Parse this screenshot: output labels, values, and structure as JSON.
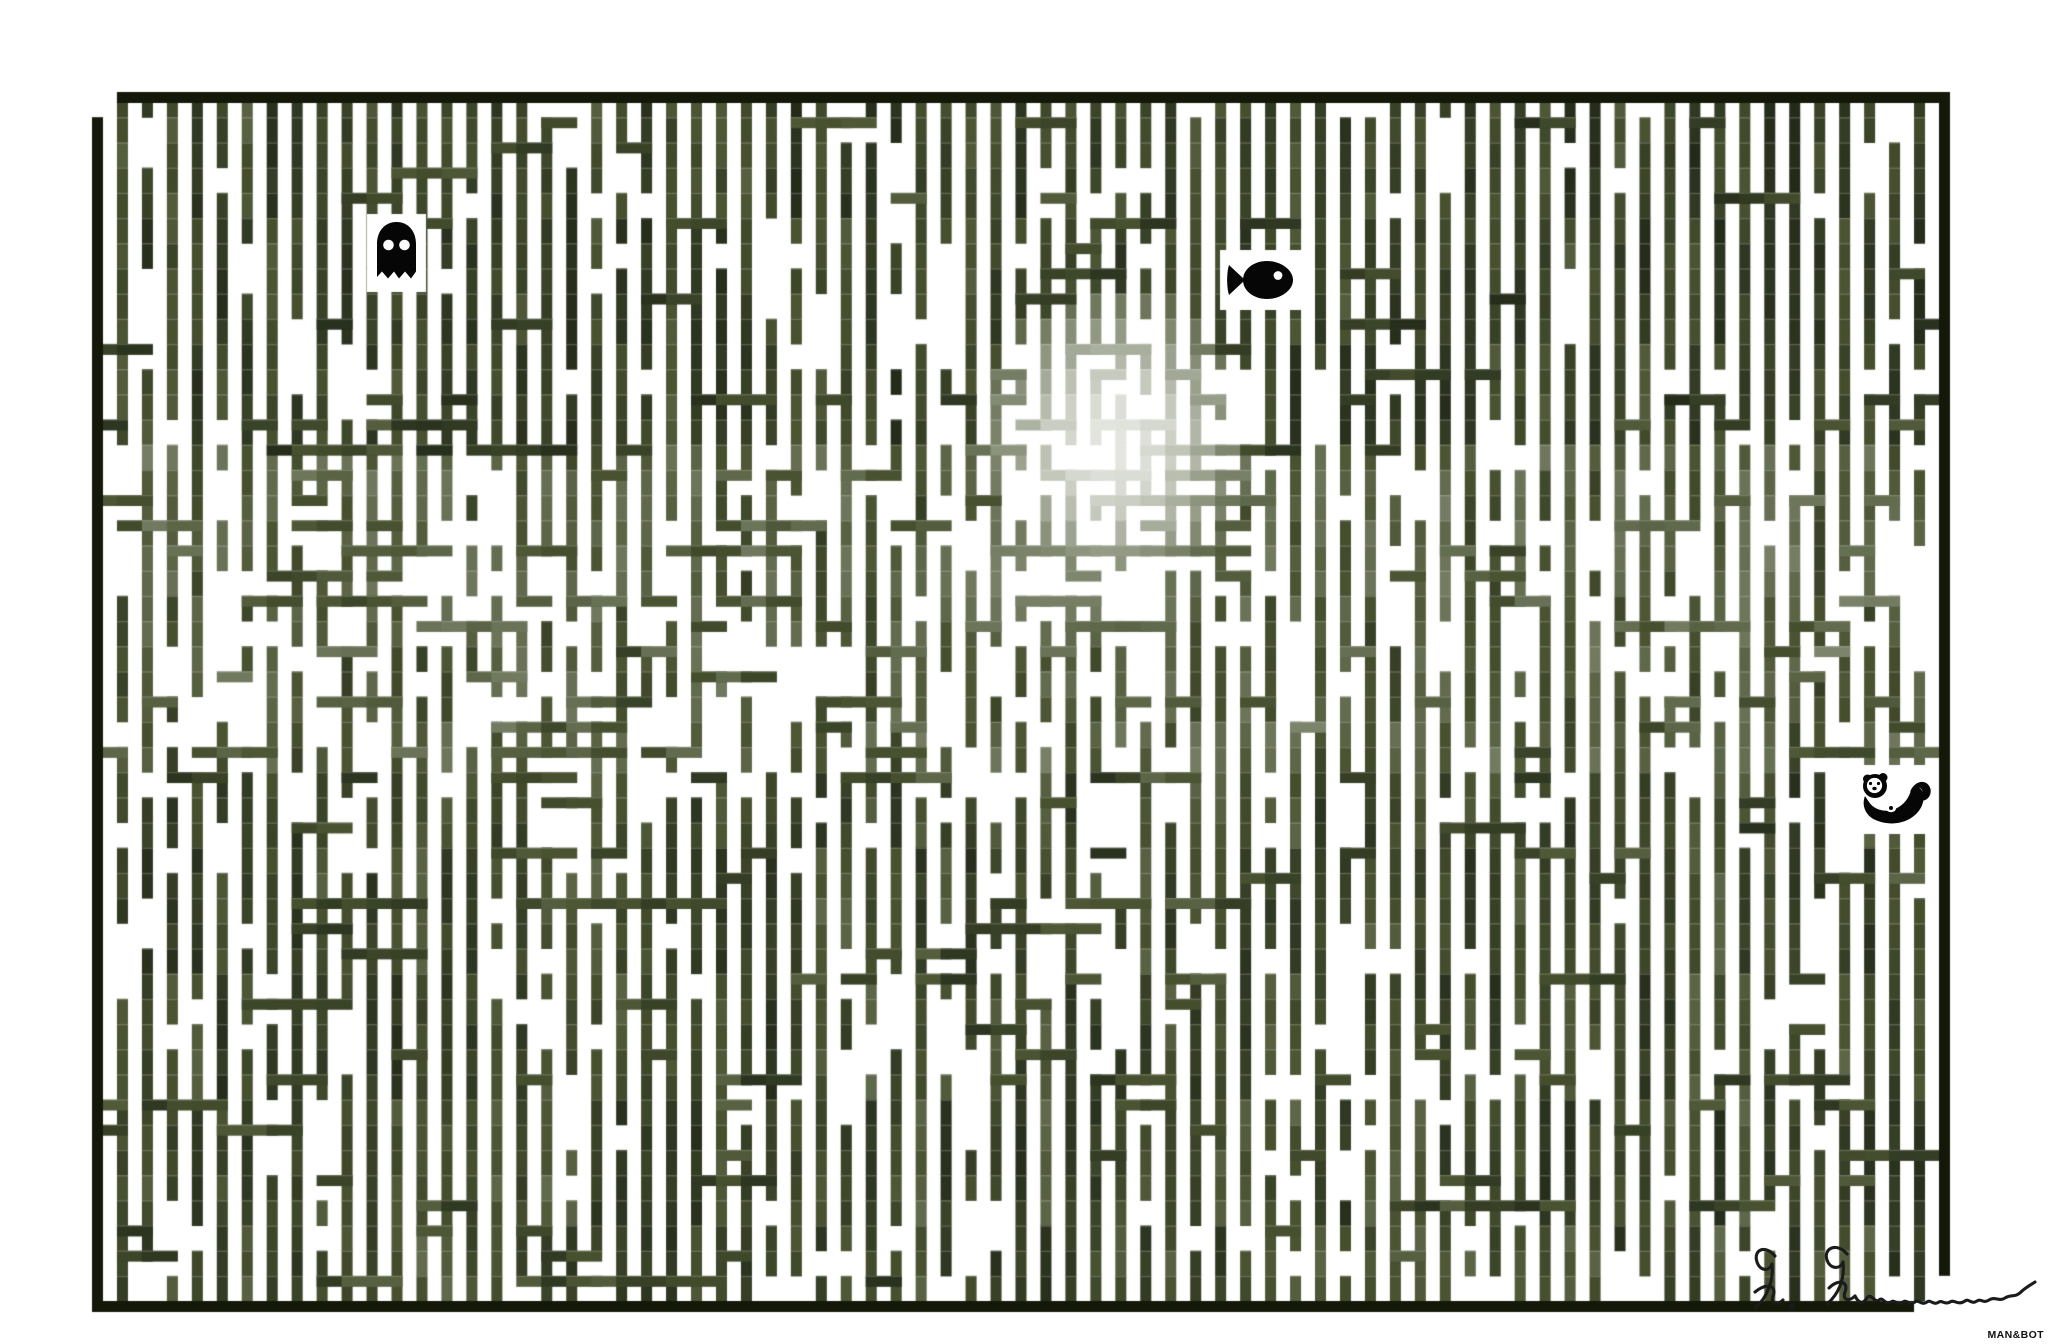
{
  "artwork": {
    "type": "striped-maze-art",
    "background": "#ffffff",
    "frame_color": "#141808",
    "icon_color": "#060606",
    "palette": [
      "#1b2112",
      "#2c3520",
      "#47512f",
      "#6e775c",
      "#99a08c",
      "#c8ccc0",
      "#f4f5f2"
    ],
    "palette_stops": [
      0,
      0.18,
      0.36,
      0.55,
      0.72,
      0.86,
      1
    ],
    "maze": {
      "left": 92,
      "top": 92,
      "right": 1939,
      "bottom": 1301,
      "cols": 74,
      "rows": 48,
      "wall_thickness": 11,
      "seed": 7,
      "entrance": "top-left-corner",
      "exit": "bottom-right-corner",
      "complexity_patches": [
        {
          "col": 40.8,
          "row": 15,
          "rx": 7,
          "ry": 6.5,
          "value": 0.62
        },
        {
          "col": 40,
          "row": 3,
          "rx": 3.5,
          "ry": 5,
          "value": 0.3
        },
        {
          "col": 13,
          "row": 20,
          "rx": 10,
          "ry": 7,
          "value": 0.45
        },
        {
          "col": 27,
          "row": 22,
          "rx": 8,
          "ry": 6,
          "value": 0.5
        },
        {
          "col": 38,
          "row": 35,
          "rx": 8,
          "ry": 5,
          "value": 0.4
        },
        {
          "col": 63,
          "row": 25,
          "rx": 6,
          "ry": 5,
          "value": 0.32
        },
        {
          "col": 68,
          "row": 38,
          "rx": 5,
          "ry": 4,
          "value": 0.3
        },
        {
          "col": 8,
          "row": 33,
          "rx": 5,
          "ry": 4,
          "value": 0.3
        }
      ],
      "bright_blobs": [
        {
          "col": 40.8,
          "row": 13.4,
          "rx": 5.6,
          "ry": 6,
          "value": 0.95
        },
        {
          "col": 38.5,
          "row": 18.6,
          "rx": 8,
          "ry": 3.4,
          "value": 0.62
        },
        {
          "col": 15,
          "row": 19,
          "rx": 4,
          "ry": 3,
          "value": 0.55
        }
      ]
    },
    "icons": [
      {
        "name": "ghost",
        "x": 374,
        "y": 221,
        "width": 45,
        "height": 64
      },
      {
        "name": "fish",
        "x": 1227,
        "y": 257,
        "width": 68,
        "height": 46
      },
      {
        "name": "otter",
        "x": 1860,
        "y": 772,
        "width": 72,
        "height": 55
      }
    ],
    "signature": {
      "text": "R. Rimmon",
      "color": "#1b1b1b",
      "x": 1745,
      "y": 1242,
      "width": 300,
      "height": 100
    },
    "watermark": {
      "text": "MAN&BOT",
      "color": "#111111"
    }
  }
}
